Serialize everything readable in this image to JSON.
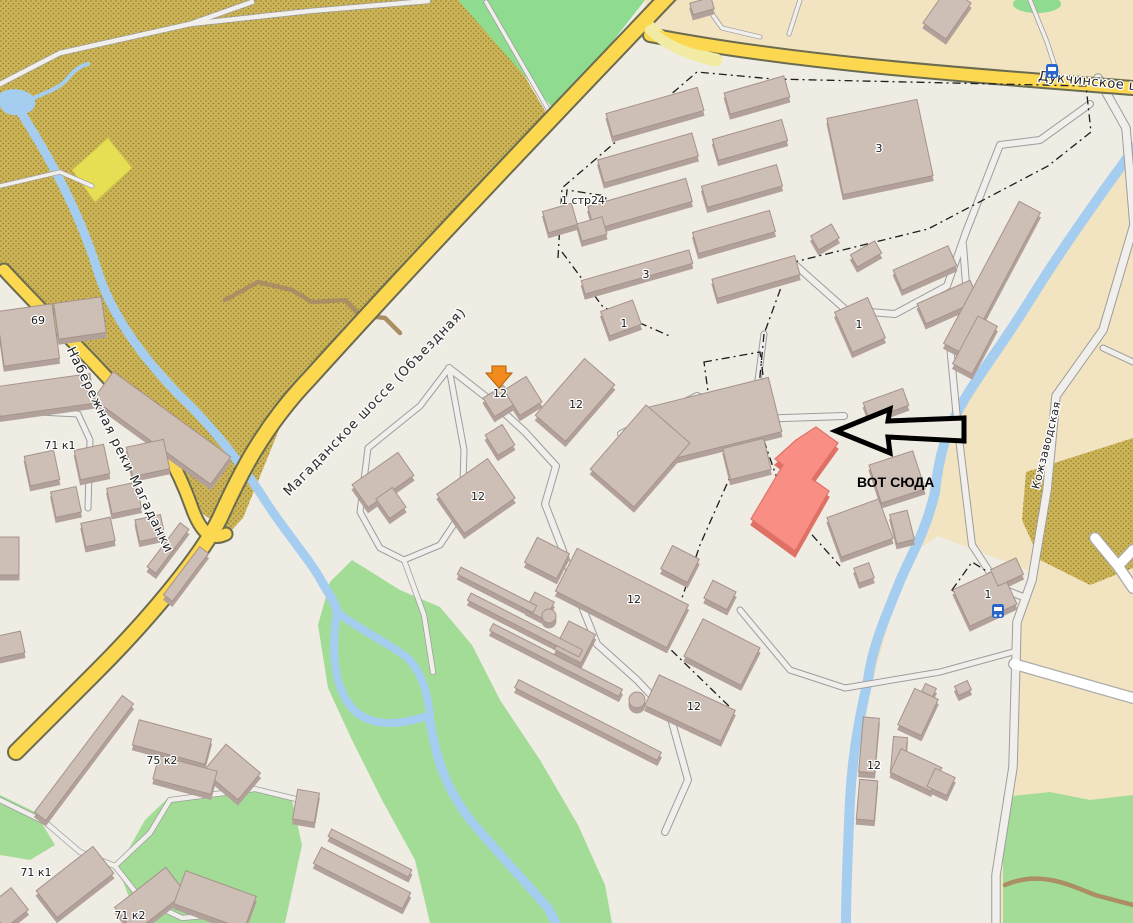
{
  "streets": {
    "magadanskoye": "Магаданское шоссе (Объездная)",
    "naberezhnaya": "Набережная реки Магаданки",
    "dukchinskoye": "Дукчинское ш",
    "kozhzavodskaya": "Кожзаводская"
  },
  "annotation": {
    "label": "ВОТ СЮДА"
  },
  "building_labels": [
    {
      "text": "69"
    },
    {
      "text": "71 к1"
    },
    {
      "text": "75 к2"
    },
    {
      "text": "71 к1"
    },
    {
      "text": "71 к2"
    },
    {
      "text": "1 стр24"
    },
    {
      "text": "3"
    },
    {
      "text": "1"
    },
    {
      "text": "12"
    },
    {
      "text": "12"
    },
    {
      "text": "12"
    },
    {
      "text": "12"
    },
    {
      "text": "12"
    },
    {
      "text": "3"
    },
    {
      "text": "1"
    },
    {
      "text": "1"
    },
    {
      "text": "12"
    }
  ],
  "icons": [
    {
      "name": "bus-stop-icon"
    },
    {
      "name": "bus-stop-icon"
    },
    {
      "name": "destination-marker-icon"
    },
    {
      "name": "annotation-arrow-icon"
    }
  ],
  "colors": {
    "urban": "#EFECE4",
    "allotments": "#CDB557",
    "allotment_dots": "#8E7C33",
    "farmland": "#F2E3C1",
    "grass": "#A3DC96",
    "green_triangle": "#8FDB8F",
    "water": "#A5CDF0",
    "road_primary": "#FBD84F",
    "road_ramp": "#F1EBA3",
    "road_minor": "#F0EFEC",
    "road_white": "#FFFFFF",
    "track_brown": "#AB8E63",
    "building": "#CDBEB6",
    "building_shadow": "#B2A19A",
    "highlight_building": "#F98E84",
    "annotation_color": "#000000",
    "marker_orange": "#F28A1D",
    "bus_icon_blue": "#2A66C9"
  }
}
